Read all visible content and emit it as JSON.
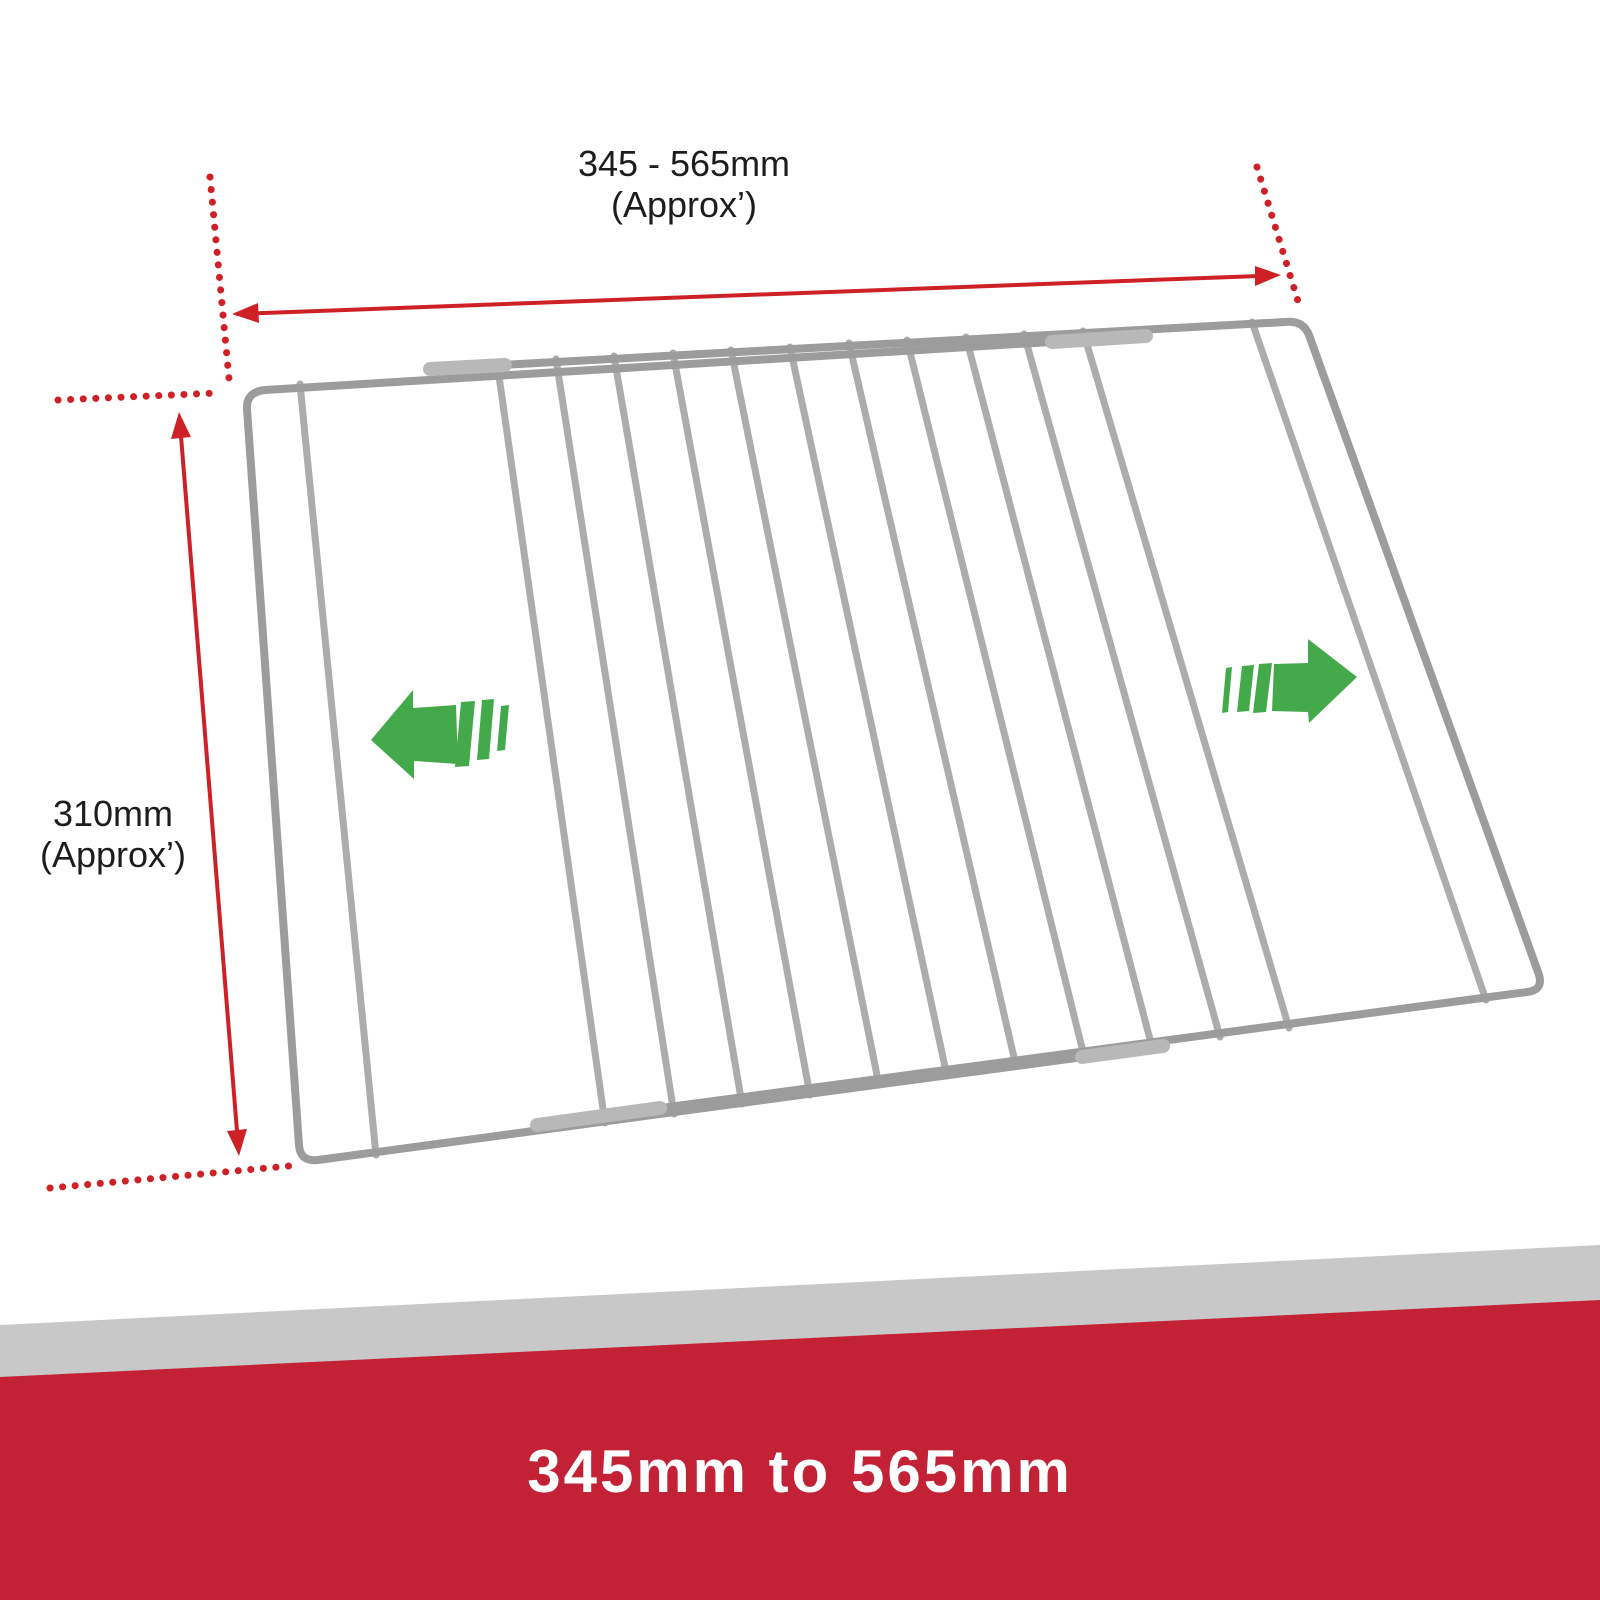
{
  "labels": {
    "width": {
      "value": "345 - 565mm",
      "qualifier": "(Approx’)"
    },
    "height": {
      "value": "310mm",
      "qualifier": "(Approx’)"
    }
  },
  "banner": {
    "text": "345mm to 565mm"
  },
  "icons": {
    "extend_left": "extend-left-arrow-icon",
    "extend_right": "extend-right-arrow-icon"
  },
  "colors": {
    "background": "#FFFFFF",
    "dimension_red": "#CE2127",
    "banner_red": "#C32136",
    "stripe_gray": "#C8C8C8",
    "arrow_green": "#44A94A",
    "wire_gray": "#ACACAC",
    "frame_gray": "#9C9C9C",
    "sleeve_gray": "#B8B8B8",
    "label_text": "#1D1D1B",
    "banner_text": "#FFFFFF"
  }
}
